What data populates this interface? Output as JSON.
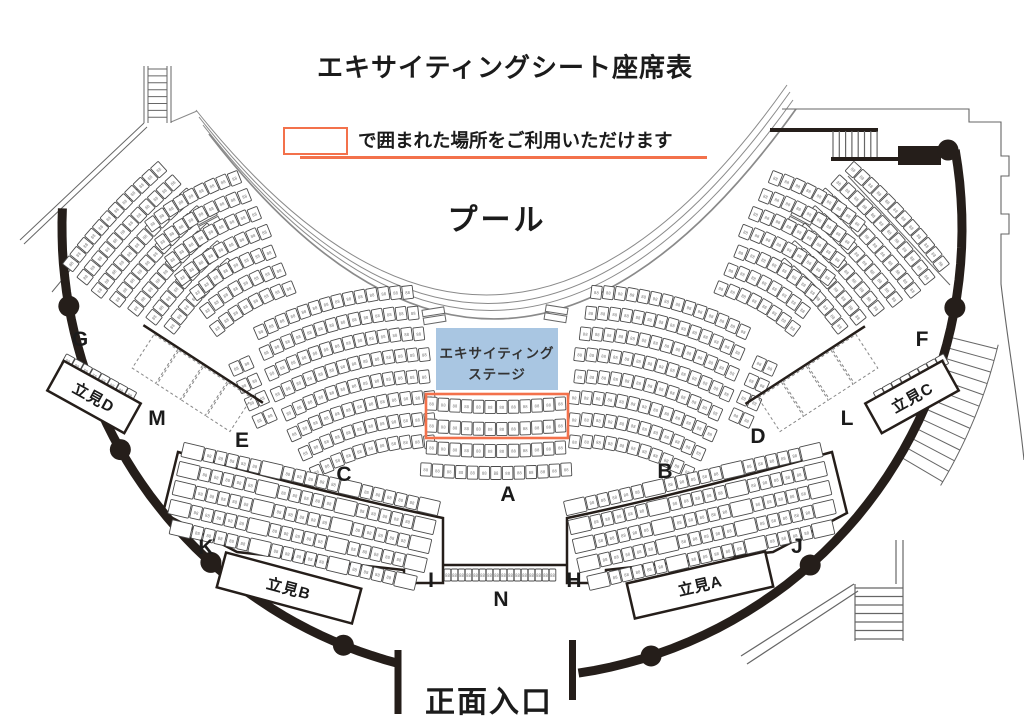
{
  "title": "エキサイティングシート座席表",
  "legend": {
    "text": "で囲まれた場所をご利用いただけます"
  },
  "pool_label": "プール",
  "entrance_label": "正面入口",
  "stage": {
    "line1": "エキサイティング",
    "line2": "ステージ"
  },
  "seat_glyph": "88",
  "colors": {
    "accent_orange": "#f3714b",
    "stage_blue": "#a9c6e2",
    "wall": "#251e1a",
    "seat_stroke": "#4a4a4a",
    "seat_num": "#777777",
    "thin_line": "#666666",
    "pool_line": "#8a8a8a",
    "text": "#1b1b1b"
  },
  "section_labels": [
    {
      "id": "G",
      "x": 80,
      "y": 340
    },
    {
      "id": "M",
      "x": 157,
      "y": 419
    },
    {
      "id": "E",
      "x": 242,
      "y": 441
    },
    {
      "id": "C",
      "x": 344,
      "y": 475
    },
    {
      "id": "A",
      "x": 508,
      "y": 495
    },
    {
      "id": "B",
      "x": 665,
      "y": 472
    },
    {
      "id": "D",
      "x": 758,
      "y": 437
    },
    {
      "id": "L",
      "x": 847,
      "y": 419
    },
    {
      "id": "F",
      "x": 922,
      "y": 340
    },
    {
      "id": "K",
      "x": 206,
      "y": 548
    },
    {
      "id": "I",
      "x": 431,
      "y": 581
    },
    {
      "id": "N",
      "x": 501,
      "y": 600
    },
    {
      "id": "H",
      "x": 574,
      "y": 581
    },
    {
      "id": "J",
      "x": 797,
      "y": 547
    }
  ],
  "standing_areas": [
    {
      "id": "D",
      "label": "立見D",
      "cx": 94,
      "cy": 397,
      "w": 88,
      "h": 34,
      "rot": 29
    },
    {
      "id": "C",
      "label": "立見C",
      "cx": 912,
      "cy": 397,
      "w": 88,
      "h": 34,
      "rot": -29
    },
    {
      "id": "B",
      "label": "立見B",
      "cx": 289,
      "cy": 588,
      "w": 140,
      "h": 36,
      "rot": 15
    },
    {
      "id": "A",
      "label": "立見A",
      "cx": 700,
      "cy": 585,
      "w": 142,
      "h": 36,
      "rot": -13
    }
  ],
  "seat_blocks": [
    {
      "id": "G",
      "cx": 158,
      "cy": 257,
      "rot": -47,
      "rows": [
        12,
        12,
        12,
        11,
        10,
        9,
        8
      ],
      "rowGap": 19.5,
      "sag": -4,
      "tilt": 5
    },
    {
      "id": "F",
      "cx": 854,
      "cy": 257,
      "rot": 47,
      "rows": [
        12,
        12,
        12,
        11,
        10,
        9,
        8
      ],
      "rowGap": 19.5,
      "sag": -4,
      "tilt": 5
    },
    {
      "id": "C-upper",
      "cx": 224,
      "cy": 256,
      "rot": -29,
      "rows": [
        9,
        9,
        9,
        9,
        8,
        8,
        8
      ],
      "rowGap": 20.5,
      "sag": -7,
      "tilt": 8
    },
    {
      "id": "B-upper",
      "cx": 786,
      "cy": 256,
      "rot": 29,
      "rows": [
        9,
        9,
        9,
        9,
        8,
        8,
        8
      ],
      "rowGap": 20.5,
      "sag": -7,
      "tilt": 8
    },
    {
      "id": "C",
      "cx": 354,
      "cy": 386,
      "rot": -15,
      "rows": [
        14,
        14,
        14,
        14,
        13,
        13,
        12,
        11
      ],
      "rowGap": 21.5,
      "sag": -11,
      "tilt": 9
    },
    {
      "id": "B",
      "cx": 650,
      "cy": 386,
      "rot": 15,
      "rows": [
        14,
        14,
        14,
        14,
        13,
        13,
        12,
        11
      ],
      "rowGap": 21.5,
      "sag": -11,
      "tilt": 9
    },
    {
      "id": "A",
      "cx": 496,
      "cy": 436,
      "rot": 0,
      "rows": [
        12,
        12,
        12,
        13
      ],
      "rowGap": 22,
      "sag": 4,
      "tilt": -3
    },
    {
      "id": "E",
      "cx": 253,
      "cy": 392,
      "rot": -24,
      "rows": [
        2,
        2,
        2,
        2
      ],
      "rowGap": 19,
      "sag": 0,
      "tilt": 0
    },
    {
      "id": "D",
      "cx": 753,
      "cy": 392,
      "rot": 24,
      "rows": [
        2,
        2,
        2,
        2
      ],
      "rowGap": 19,
      "sag": 0,
      "tilt": 0
    },
    {
      "id": "K-I",
      "cx": 302,
      "cy": 517,
      "rot": 13,
      "rows": [
        15,
        15,
        15,
        15,
        14
      ],
      "rowGap": 19.5,
      "sag": 0,
      "tilt": 0,
      "flank": true
    },
    {
      "id": "H-J",
      "cx": 702,
      "cy": 517,
      "rot": -13,
      "rows": [
        15,
        15,
        15,
        15,
        14
      ],
      "rowGap": 19.5,
      "sag": 0,
      "tilt": 0,
      "flank": true
    },
    {
      "id": "N",
      "cx": 500,
      "cy": 575,
      "rot": 0,
      "rows": [
        16
      ],
      "seatW": 6.6,
      "seatH": 12,
      "gapX": 0.4,
      "sag": 0,
      "tilt": 0
    },
    {
      "id": "stand-strip-D",
      "cx": 99,
      "cy": 378,
      "rot": 29,
      "rows": [
        8
      ],
      "seatW": 9.5,
      "seatH": 11,
      "gapX": 0.6,
      "sag": 0,
      "tilt": 0
    },
    {
      "id": "stand-strip-C",
      "cx": 911,
      "cy": 378,
      "rot": -29,
      "rows": [
        8
      ],
      "seatW": 9.5,
      "seatH": 11,
      "gapX": 0.6,
      "sag": 0,
      "tilt": 0
    }
  ],
  "dashed_blocks": [
    {
      "id": "M",
      "cx": 192,
      "cy": 383,
      "rot": 33,
      "cells": 4,
      "cellW": 28,
      "cellH": 40
    },
    {
      "id": "L",
      "cx": 818,
      "cy": 383,
      "rot": -33,
      "cells": 4,
      "cellW": 28,
      "cellH": 40
    }
  ],
  "stage_box": {
    "x": 436,
    "y": 328,
    "w": 122,
    "h": 62
  },
  "highlight_box": {
    "x": 426,
    "y": 394,
    "w": 142,
    "h": 44
  },
  "legend_geom": {
    "box": {
      "x": 283,
      "y": 127,
      "w": 61,
      "h": 24
    },
    "underline": {
      "x": 300,
      "y": 156,
      "w": 407
    },
    "text_x": 358,
    "text_y": 140
  }
}
